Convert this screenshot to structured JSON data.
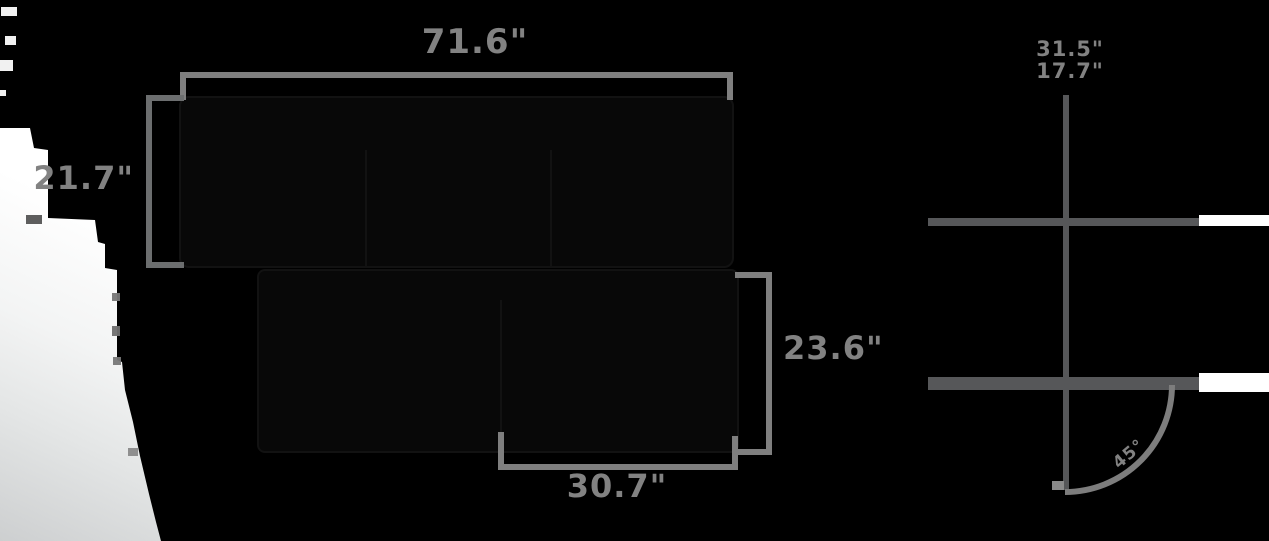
{
  "figure": "sofa-dimension-diagram",
  "colors": {
    "background": "#000000",
    "dimension_line": "#7f7f7f",
    "side_view_line": "#565759",
    "label_text": "#828282",
    "backdrop_white": "#ffffff"
  },
  "top_view": {
    "width_label": "71.6\"",
    "seat_depth_label": "21.7\"",
    "chaise_depth_label": "23.6\"",
    "chaise_width_label": "30.7\""
  },
  "side_view": {
    "height_labels": [
      "31.5\"",
      "17.7\""
    ],
    "angle_label": "45°"
  }
}
